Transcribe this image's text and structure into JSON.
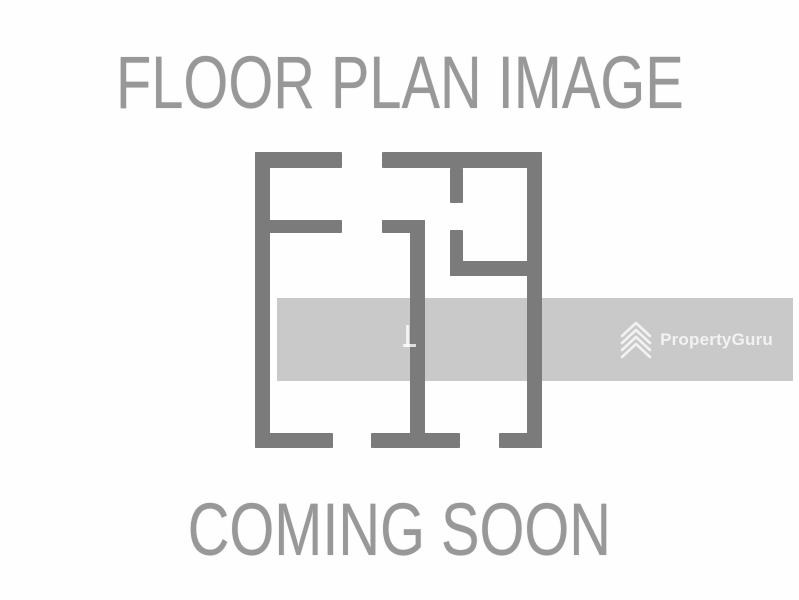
{
  "placeholder": {
    "top_text": "FLOOR PLAN IMAGE",
    "bottom_text": "COMING SOON",
    "text_color": "#989898",
    "floor_plan_icon": "floor-plan-icon",
    "wall_color": "#7b7b7b"
  },
  "watermark": {
    "brand": "PropertyGuru",
    "logo_icon": "propertyguru-chevrons-icon",
    "band_color": "#c9c9c9",
    "foreground_color": "#f2f2f2"
  }
}
